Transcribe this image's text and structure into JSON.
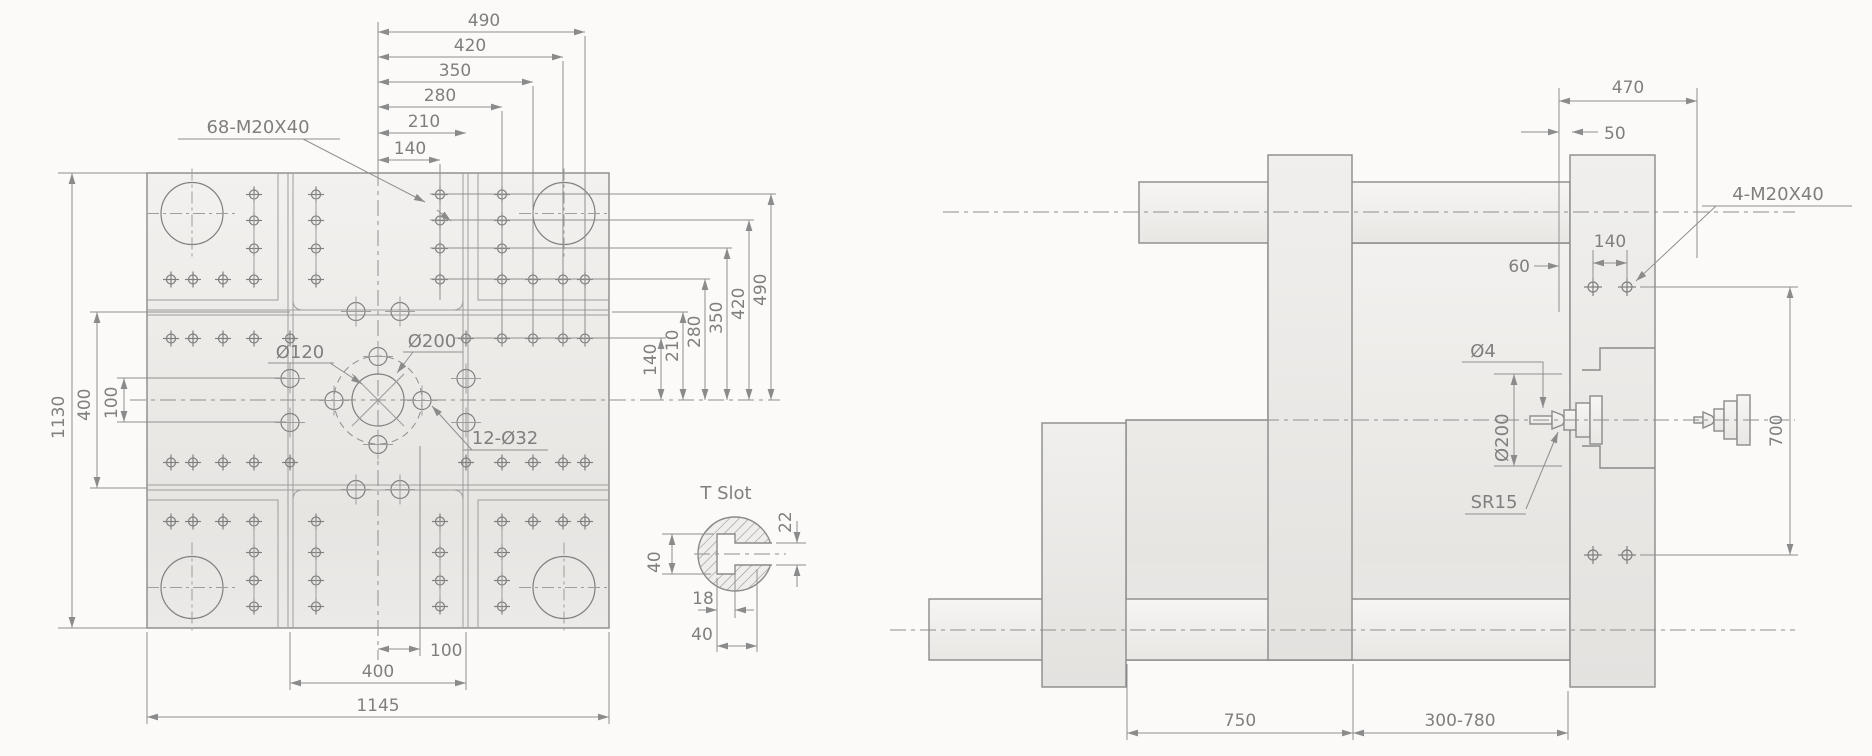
{
  "drawing_title": "platen machining drawing",
  "colors": {
    "background": "#fbfaf8",
    "line": "#8a8a8a",
    "dim_line": "#8f8f8f",
    "text": "#7f7f7f",
    "fill_light": "#f1f0ee",
    "fill_dark": "#e7e5e2"
  },
  "front_view": {
    "hole_note": "68-M20X40",
    "center_hole_label": "Ø120",
    "bolt_circle_label": "Ø200",
    "small_holes_label": "12-Ø32",
    "dims_top": [
      "490",
      "420",
      "350",
      "280",
      "210",
      "140"
    ],
    "dims_right": [
      "140",
      "210",
      "280",
      "350",
      "420",
      "490"
    ],
    "dims_left": [
      "1130",
      "400",
      "100"
    ],
    "dims_bottom": [
      "100",
      "400",
      "1145"
    ]
  },
  "tslot_detail": {
    "title": "T Slot",
    "dim_back_width": "40",
    "dim_slot_height": "22",
    "dim_neck_depth": "18",
    "dim_total_depth": "40"
  },
  "side_view": {
    "dim_470": "470",
    "dim_50": "50",
    "dim_140": "140",
    "dim_60": "60",
    "hole_note": "4-M20X40",
    "orifice_label": "Ø4",
    "ring_label": "Ø200",
    "sphere_label": "SR15",
    "dim_700": "700",
    "dim_750": "750",
    "dim_stroke": "300-780"
  }
}
